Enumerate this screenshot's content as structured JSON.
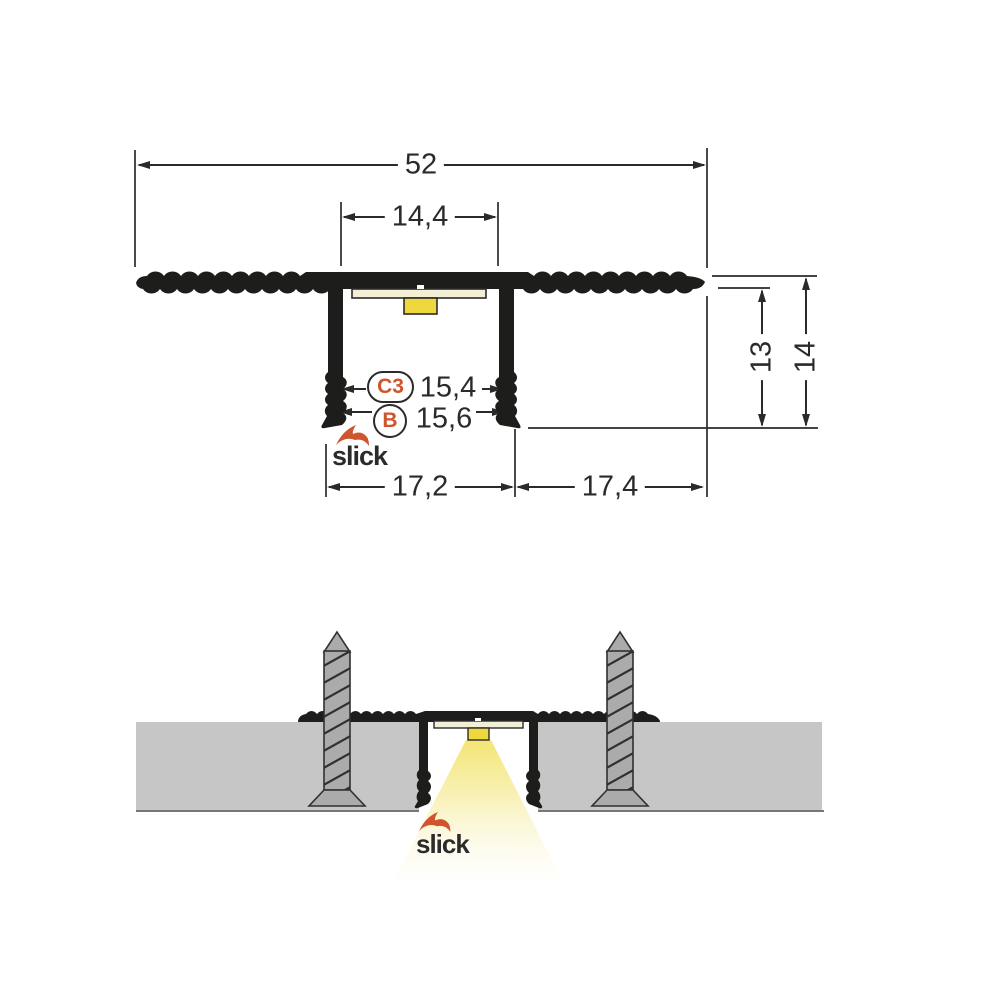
{
  "drawing_title": "slick LED profile cross-section technical drawing",
  "colors": {
    "profile_black": "#1d1d1b",
    "accent_orange": "#d0542c",
    "led_yellow": "#efd73e",
    "pcb_cream": "#f3eed6",
    "slab_gray": "#c6c6c6",
    "screw_gray": "#ababab",
    "light_warm_yellow": "#f5e87b",
    "dimension_line": "#2a2a2a"
  },
  "top_view": {
    "dim_overall_width": "52",
    "dim_channel_width": "14,4",
    "marker_c3": {
      "label": "C3",
      "dim": "15,4"
    },
    "marker_b": {
      "label": "B",
      "dim": "15,6"
    },
    "dim_left_segment": "17,2",
    "dim_right_segment": "17,4",
    "dim_inner_depth": "13",
    "dim_overall_height": "14",
    "logo_text": "slick"
  },
  "bottom_view": {
    "logo_text": "slick"
  }
}
